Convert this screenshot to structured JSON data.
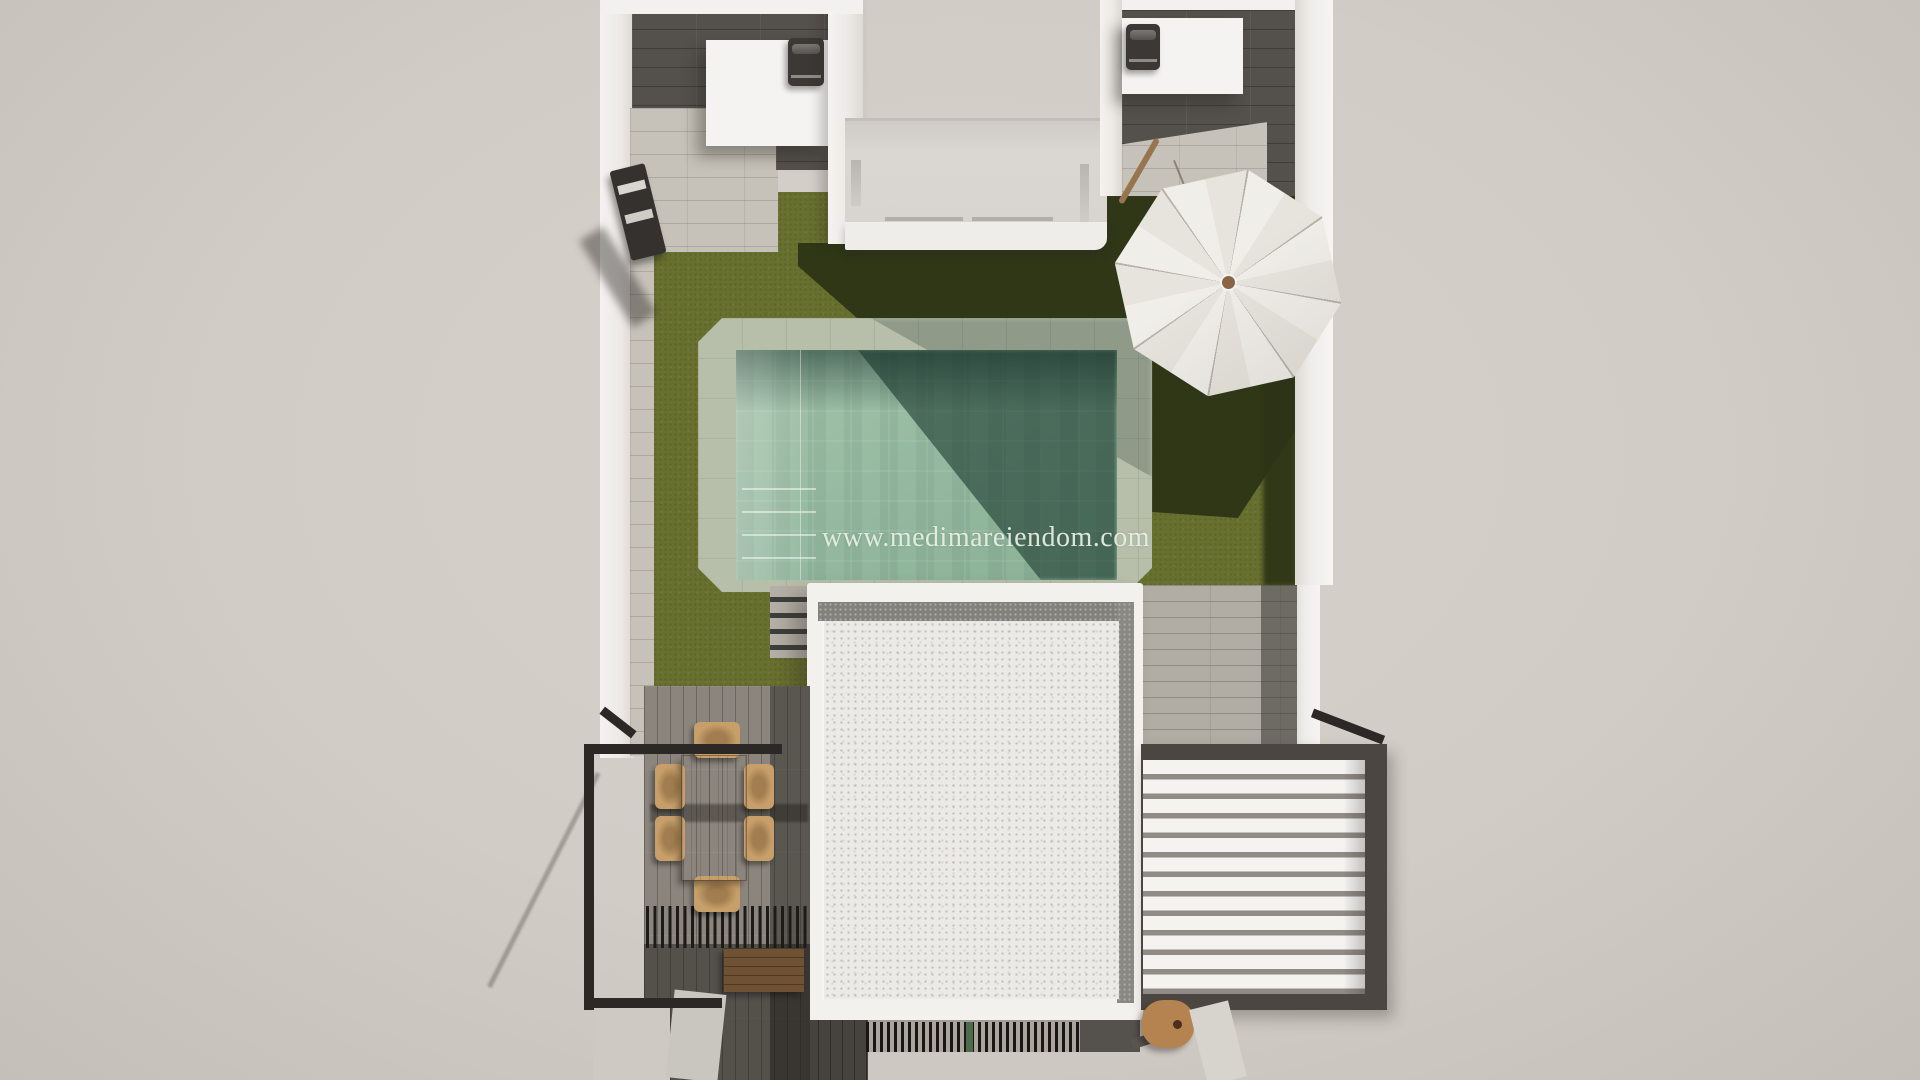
{
  "watermark": {
    "text": "www.medimareiendom.com"
  },
  "palette": {
    "background": "#d2ccc6",
    "wall_white": "#f2f1ee",
    "dark_tile_floor": "#54504c",
    "travertine_tile": "#c7c2b9",
    "grass": "#68702f",
    "grass_shadow": "#2c3316",
    "pool_coping": "#b7bfab",
    "pool_water": "#93b89f",
    "pool_water_shadow": "#3c5b4e",
    "wood_deck": "#8b857d",
    "dining_wood": "#c79f6a",
    "bench_wood": "#6f5134",
    "umbrella_canopy": "#eceae5",
    "umbrella_knob": "#8a6544",
    "railing_black": "#2b2826",
    "pergola_frame": "#4b4642",
    "pergola_slats": "#f4f3f0",
    "gravel_roof": "#eceae6",
    "grate_black": "#191715"
  },
  "scene": {
    "type": "3d-top-view-architectural-render",
    "objects": [
      "bbq-grill-left",
      "bbq-grill-right",
      "outdoor-kitchen-counter-left",
      "outdoor-kitchen-counter-right",
      "upper-terrace",
      "sun-lounger",
      "swimming-pool",
      "pool-interior-steps",
      "exterior-steps",
      "garden-lawn",
      "parasol-umbrella",
      "gravel-roof-building",
      "dining-table",
      "dining-chairs",
      "wood-bench",
      "black-slat-shade",
      "black-railing",
      "slatted-pergola-roof",
      "wood-stool",
      "vent-grate"
    ],
    "dining_chairs_count": 6
  }
}
